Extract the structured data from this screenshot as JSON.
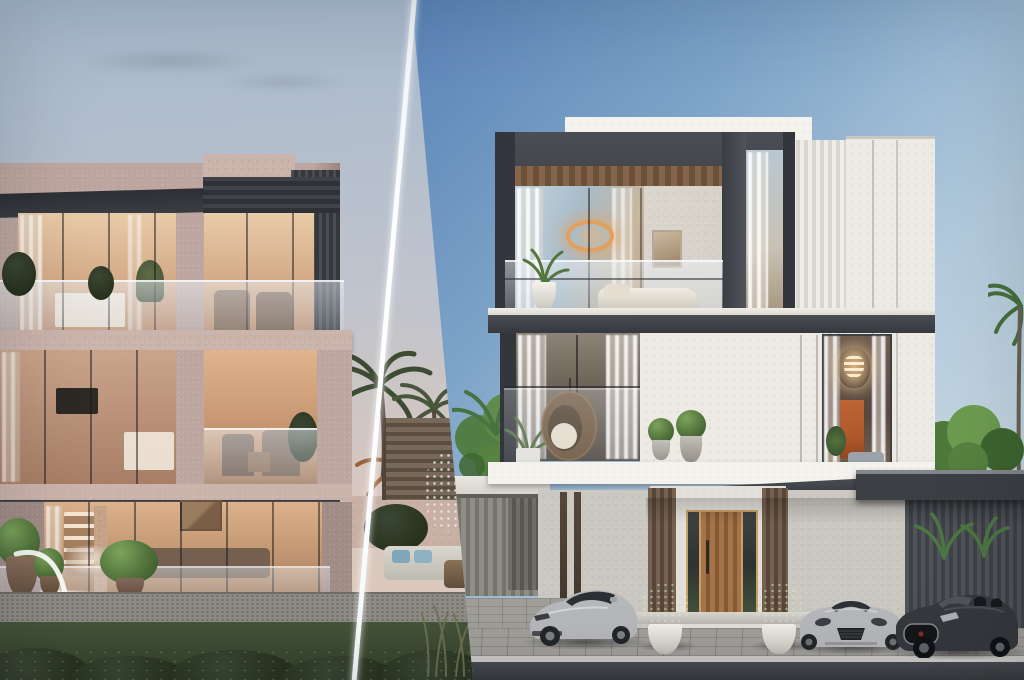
{
  "scene": {
    "type": "villa-exterior-render-split",
    "left_panel": {
      "label": "dusk-villa-scene",
      "objects": [
        "three-storey-stone-villa",
        "lit-interiors",
        "glass-balustrade-balcony",
        "balcony-dining-set",
        "living-room-glass-wall",
        "pool-with-water-spout",
        "topiary-planters",
        "palm-trees",
        "wood-slat-fence",
        "outdoor-lounge-sofa",
        "gravel-path",
        "lawn",
        "shrub-row"
      ]
    },
    "right_panel": {
      "label": "daylight-villa-scene",
      "objects": [
        "white-modern-villa",
        "dark-frame-top-floor",
        "wood-slat-soffit",
        "ring-pendant-light",
        "balcony-daybed",
        "hanging-egg-chair",
        "crystal-chandelier-window",
        "orange-artwork",
        "fluted-panel",
        "wooden-entry-door",
        "topiary-pots",
        "silver-sports-car",
        "silver-convertible",
        "dark-convertible",
        "carport-slat-wall",
        "green-tree",
        "palm-trees",
        "paved-driveway",
        "road"
      ]
    },
    "divider": "diagonal-white-line"
  },
  "colors": {
    "left_sky_top": "#a6b8cc",
    "left_sky_mid": "#bfc4cd",
    "left_sky_low": "#d6c7c0",
    "left_sky_horizon": "#decabc",
    "left_facade": "#bda69f",
    "left_facade_light": "#cab3ab",
    "left_facade_dark": "#a18c86",
    "dark_fascia": "#33363b",
    "slat_dark": "#3d4045",
    "warm_hi": "#e9cba8",
    "warm_lo": "#c39474",
    "interior_dark": "#6d5747",
    "pool_glow": "#bcdcc4",
    "pool_water": "#6f9a8e",
    "lawn": "#46543c",
    "lawn_dark": "#313f2a",
    "gravel": "#8f8c85",
    "palm_green": "#3d4b33",
    "palm_green2": "#48563c",
    "frond_orange": "#97613a",
    "fence_wood": "#6f6253",
    "sofa_white": "#dad7ce",
    "cushion_blue": "#7fa6b9",
    "wood_table": "#6f5742",
    "right_sky_top": "#3166a7",
    "right_sky_mid": "#7ca3c7",
    "right_sky_low": "#d8e2e7",
    "white_facade": "#eceae3",
    "white_bright": "#f4f2ec",
    "fluted_light": "#efede6",
    "fluted_dark": "#d9d6cf",
    "frame_dark": "#44474d",
    "frame_darker": "#33363b",
    "wood_slat": "#7c5f45",
    "wood_slat_dark": "#5e452f",
    "glass_blue": "#a3b9c9",
    "curtain": "#e9e4dc",
    "pendant_warm": "#e2a05c",
    "chandelier_warm": "#eecf9d",
    "art_orange": "#b2592c",
    "rattan": "#6d5339",
    "plant_green": "#55753f",
    "topiary_green": "#587b41",
    "pot_white": "#eae7e0",
    "pot_grey": "#b9b6af",
    "door_wood": "#9c6b3e",
    "door_wood_dark": "#7b5230",
    "bronze": "#6b5948",
    "gold_trim": "#c9a06a",
    "wall_grey": "#cbc8c1",
    "slat_wall": "#505358",
    "carport_roof": "#3c3f43",
    "fascia_light": "#83878c",
    "car_silver": "#b6b8bb",
    "car_silver_hi": "#d8dadc",
    "car_dark": "#35383d",
    "paver": "#a19f9a",
    "curb": "#cbcac6",
    "road": "#47494d",
    "road_dark": "#383a3e",
    "tree_green": "#4f7a3c",
    "tree_green_hi": "#6d9c50",
    "tree_green_dark": "#3e652f",
    "divider_white": "#ffffff"
  }
}
